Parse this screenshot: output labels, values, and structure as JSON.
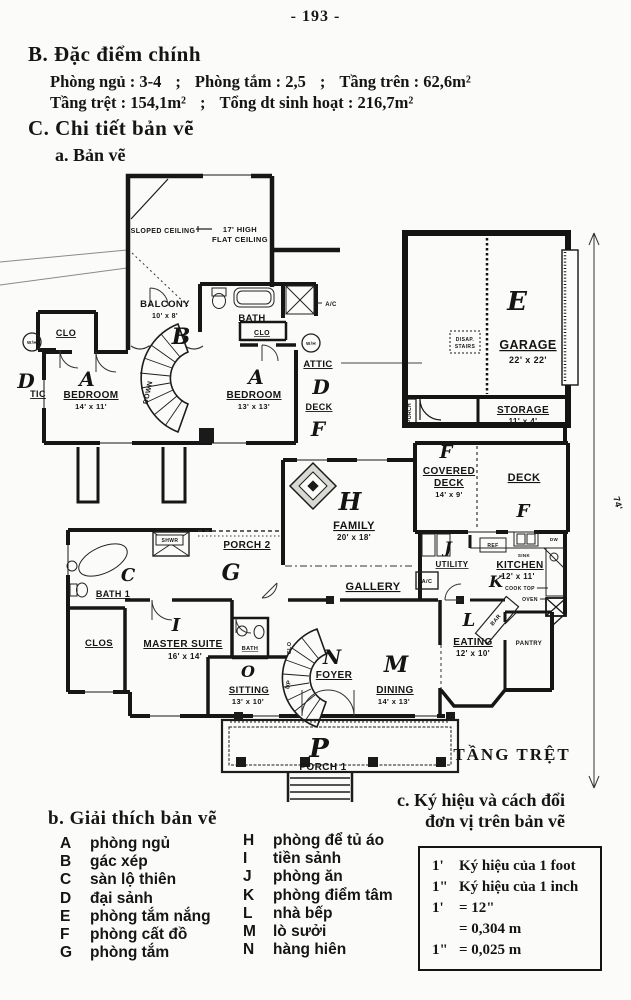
{
  "page_number": "- 193 -",
  "section_b": {
    "heading": "B. Đặc điểm chính",
    "sep": ";",
    "row1": [
      "Phòng ngủ : 3-4",
      "Phòng tắm : 2,5",
      "Tầng trên : 62,6m²"
    ],
    "row2": [
      "Tầng trệt : 154,1m²",
      "Tổng dt sinh hoạt : 216,7m²"
    ]
  },
  "section_c": {
    "heading": "C. Chi tiết bản vẽ",
    "sub_a": "a. Bản vẽ"
  },
  "legend": {
    "heading": "b. Giải thích bản vẽ",
    "left": [
      {
        "key": "A",
        "label": "phòng ngủ"
      },
      {
        "key": "B",
        "label": "gác xép"
      },
      {
        "key": "C",
        "label": "sàn lộ thiên"
      },
      {
        "key": "D",
        "label": "đại sảnh"
      },
      {
        "key": "E",
        "label": "phòng tắm nắng"
      },
      {
        "key": "F",
        "label": "phòng cất đồ"
      },
      {
        "key": "G",
        "label": "phòng tắm"
      }
    ],
    "right": [
      {
        "key": "H",
        "label": "phòng để tủ áo"
      },
      {
        "key": "I",
        "label": "tiền sảnh"
      },
      {
        "key": "J",
        "label": "phòng ăn"
      },
      {
        "key": "K",
        "label": "phòng điểm tâm"
      },
      {
        "key": "L",
        "label": "nhà bếp"
      },
      {
        "key": "M",
        "label": "lò sưởi"
      },
      {
        "key": "N",
        "label": "hàng hiên"
      }
    ]
  },
  "units": {
    "heading1": "c. Ký hiệu và cách đổi",
    "heading2": "đơn vị trên bản vẽ",
    "rows": [
      {
        "sym": "1'",
        "text": "Ký hiệu của 1 foot"
      },
      {
        "sym": "1\"",
        "text": "Ký hiệu của 1 inch"
      },
      {
        "sym": "1'",
        "text": "= 12\""
      },
      {
        "sym": "",
        "text": "= 0,304 m"
      },
      {
        "sym": "1\"",
        "text": "= 0,025 m"
      }
    ]
  },
  "plan": {
    "sloped_ceiling": "SLOPED CEILING",
    "ceiling_height": "17' HIGH",
    "flat_ceiling": "FLAT CEILING",
    "balcony": "BALCONY",
    "balcony_dims": "10' x 8'",
    "bath_upper": "BATH",
    "bath_upper_clo": "CLO",
    "ac": "A/C",
    "wh": "W/H",
    "attic": "ATTIC",
    "attic_cut": "TIC",
    "deck_upper": "DECK",
    "clo": "CLO",
    "bedroom": "BEDROOM",
    "bedroom1_dims": "14' x 11'",
    "bedroom2_dims": "13' x 13'",
    "down": "DOWN",
    "up": "UP",
    "garage": "GARAGE",
    "garage_dims": "22' x 22'",
    "disap_stairs_1": "DISAP.",
    "disap_stairs_2": "STAIRS",
    "storage": "STORAGE",
    "storage_dims": "11' x 4'",
    "porch_vertical": "PORCH",
    "overall_depth": "74'",
    "covered_deck_1": "COVERED",
    "covered_deck_2": "DECK",
    "covered_deck_dims": "14' x 9'",
    "deck": "DECK",
    "family": "FAMILY",
    "family_dims": "20' x 18'",
    "porch2": "PORCH 2",
    "gallery": "GALLERY",
    "utility": "UTILITY",
    "kitchen": "KITCHEN",
    "kitchen_dims": "12' x 11'",
    "ref": "REF",
    "sink": "SINK",
    "dw": "DW",
    "cook_top": "COOK TOP",
    "oven": "OVEN",
    "shwr": "SHWR",
    "bath1": "BATH 1",
    "clos": "CLOS",
    "master_suite": "MASTER SUITE",
    "master_dims": "16' x 14'",
    "bath_small": "BATH",
    "sitting": "SITTING",
    "sitting_dims": "13' x 10'",
    "foyer": "FOYER",
    "foyer_clo": "CLO",
    "dining": "DINING",
    "dining_dims": "14' x 13'",
    "eating": "EATING",
    "eating_dims": "12' x 10'",
    "bar": "BAR",
    "pantry": "PANTRY",
    "porch1": "PORCH 1",
    "floor_label": "TẦNG TRỆT",
    "letters": {
      "a": "A",
      "b": "B",
      "c": "C",
      "d": "D",
      "e": "E",
      "f": "F",
      "g": "G",
      "h": "H",
      "i": "I",
      "j": "J",
      "k": "K",
      "l": "L",
      "m": "M",
      "n": "N",
      "o": "O",
      "p": "P"
    }
  }
}
